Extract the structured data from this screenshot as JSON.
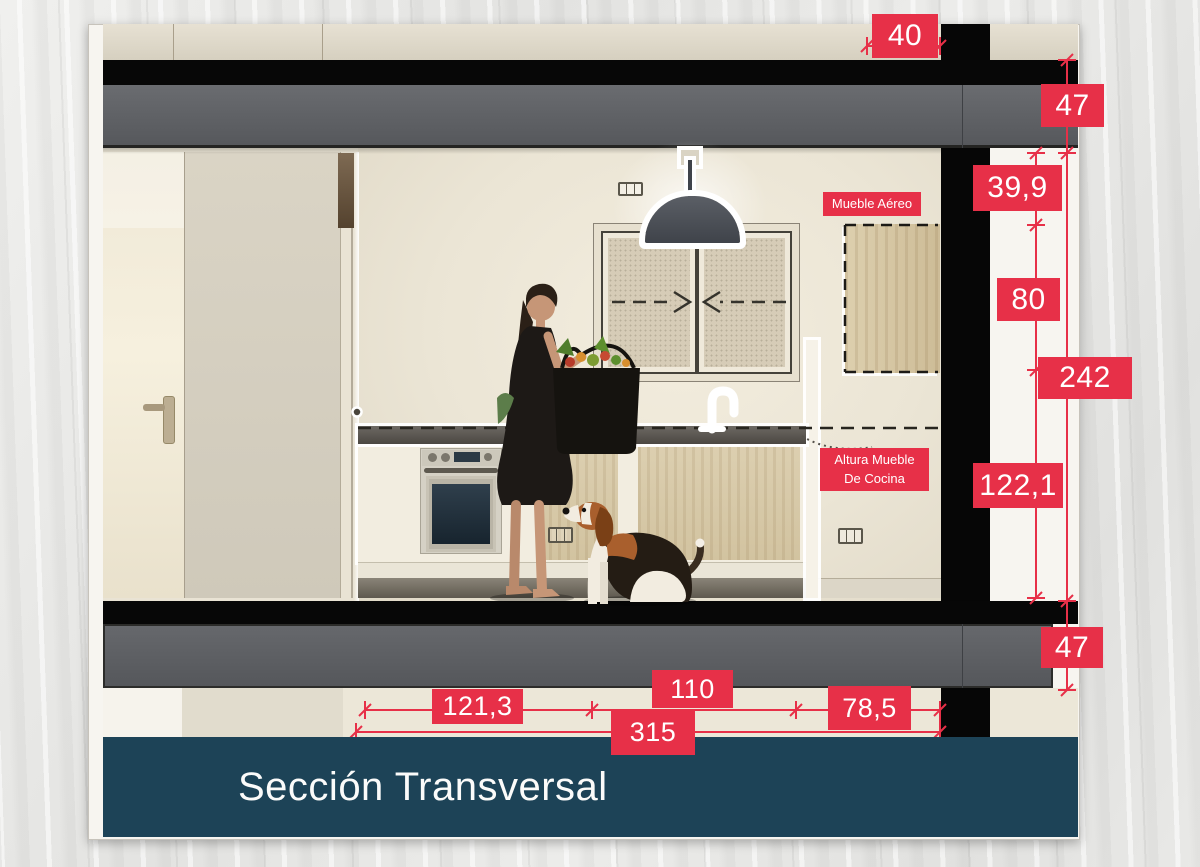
{
  "drawing_title": "Sección Transversal",
  "annotations": {
    "mueble_aereo": "Mueble Aéreo",
    "altura_mueble_line1": "Altura Mueble",
    "altura_mueble_line2": "De Cocina"
  },
  "dimensions": {
    "cabinet_depth_top": "40",
    "roof_slab_thickness": "47",
    "ceiling_to_cabinet": "39,9",
    "wall_cabinet_height": "80",
    "room_clear_height": "242",
    "counter_to_floor": "122,1",
    "floor_slab_thickness": "47",
    "span_left": "121,3",
    "span_middle": "110",
    "span_right": "78,5",
    "span_total": "315"
  },
  "colors": {
    "dimension_red": "#e73048",
    "title_bar_teal": "#1d4357",
    "slab_gray": "#5e6064",
    "slab_black": "#070707"
  }
}
